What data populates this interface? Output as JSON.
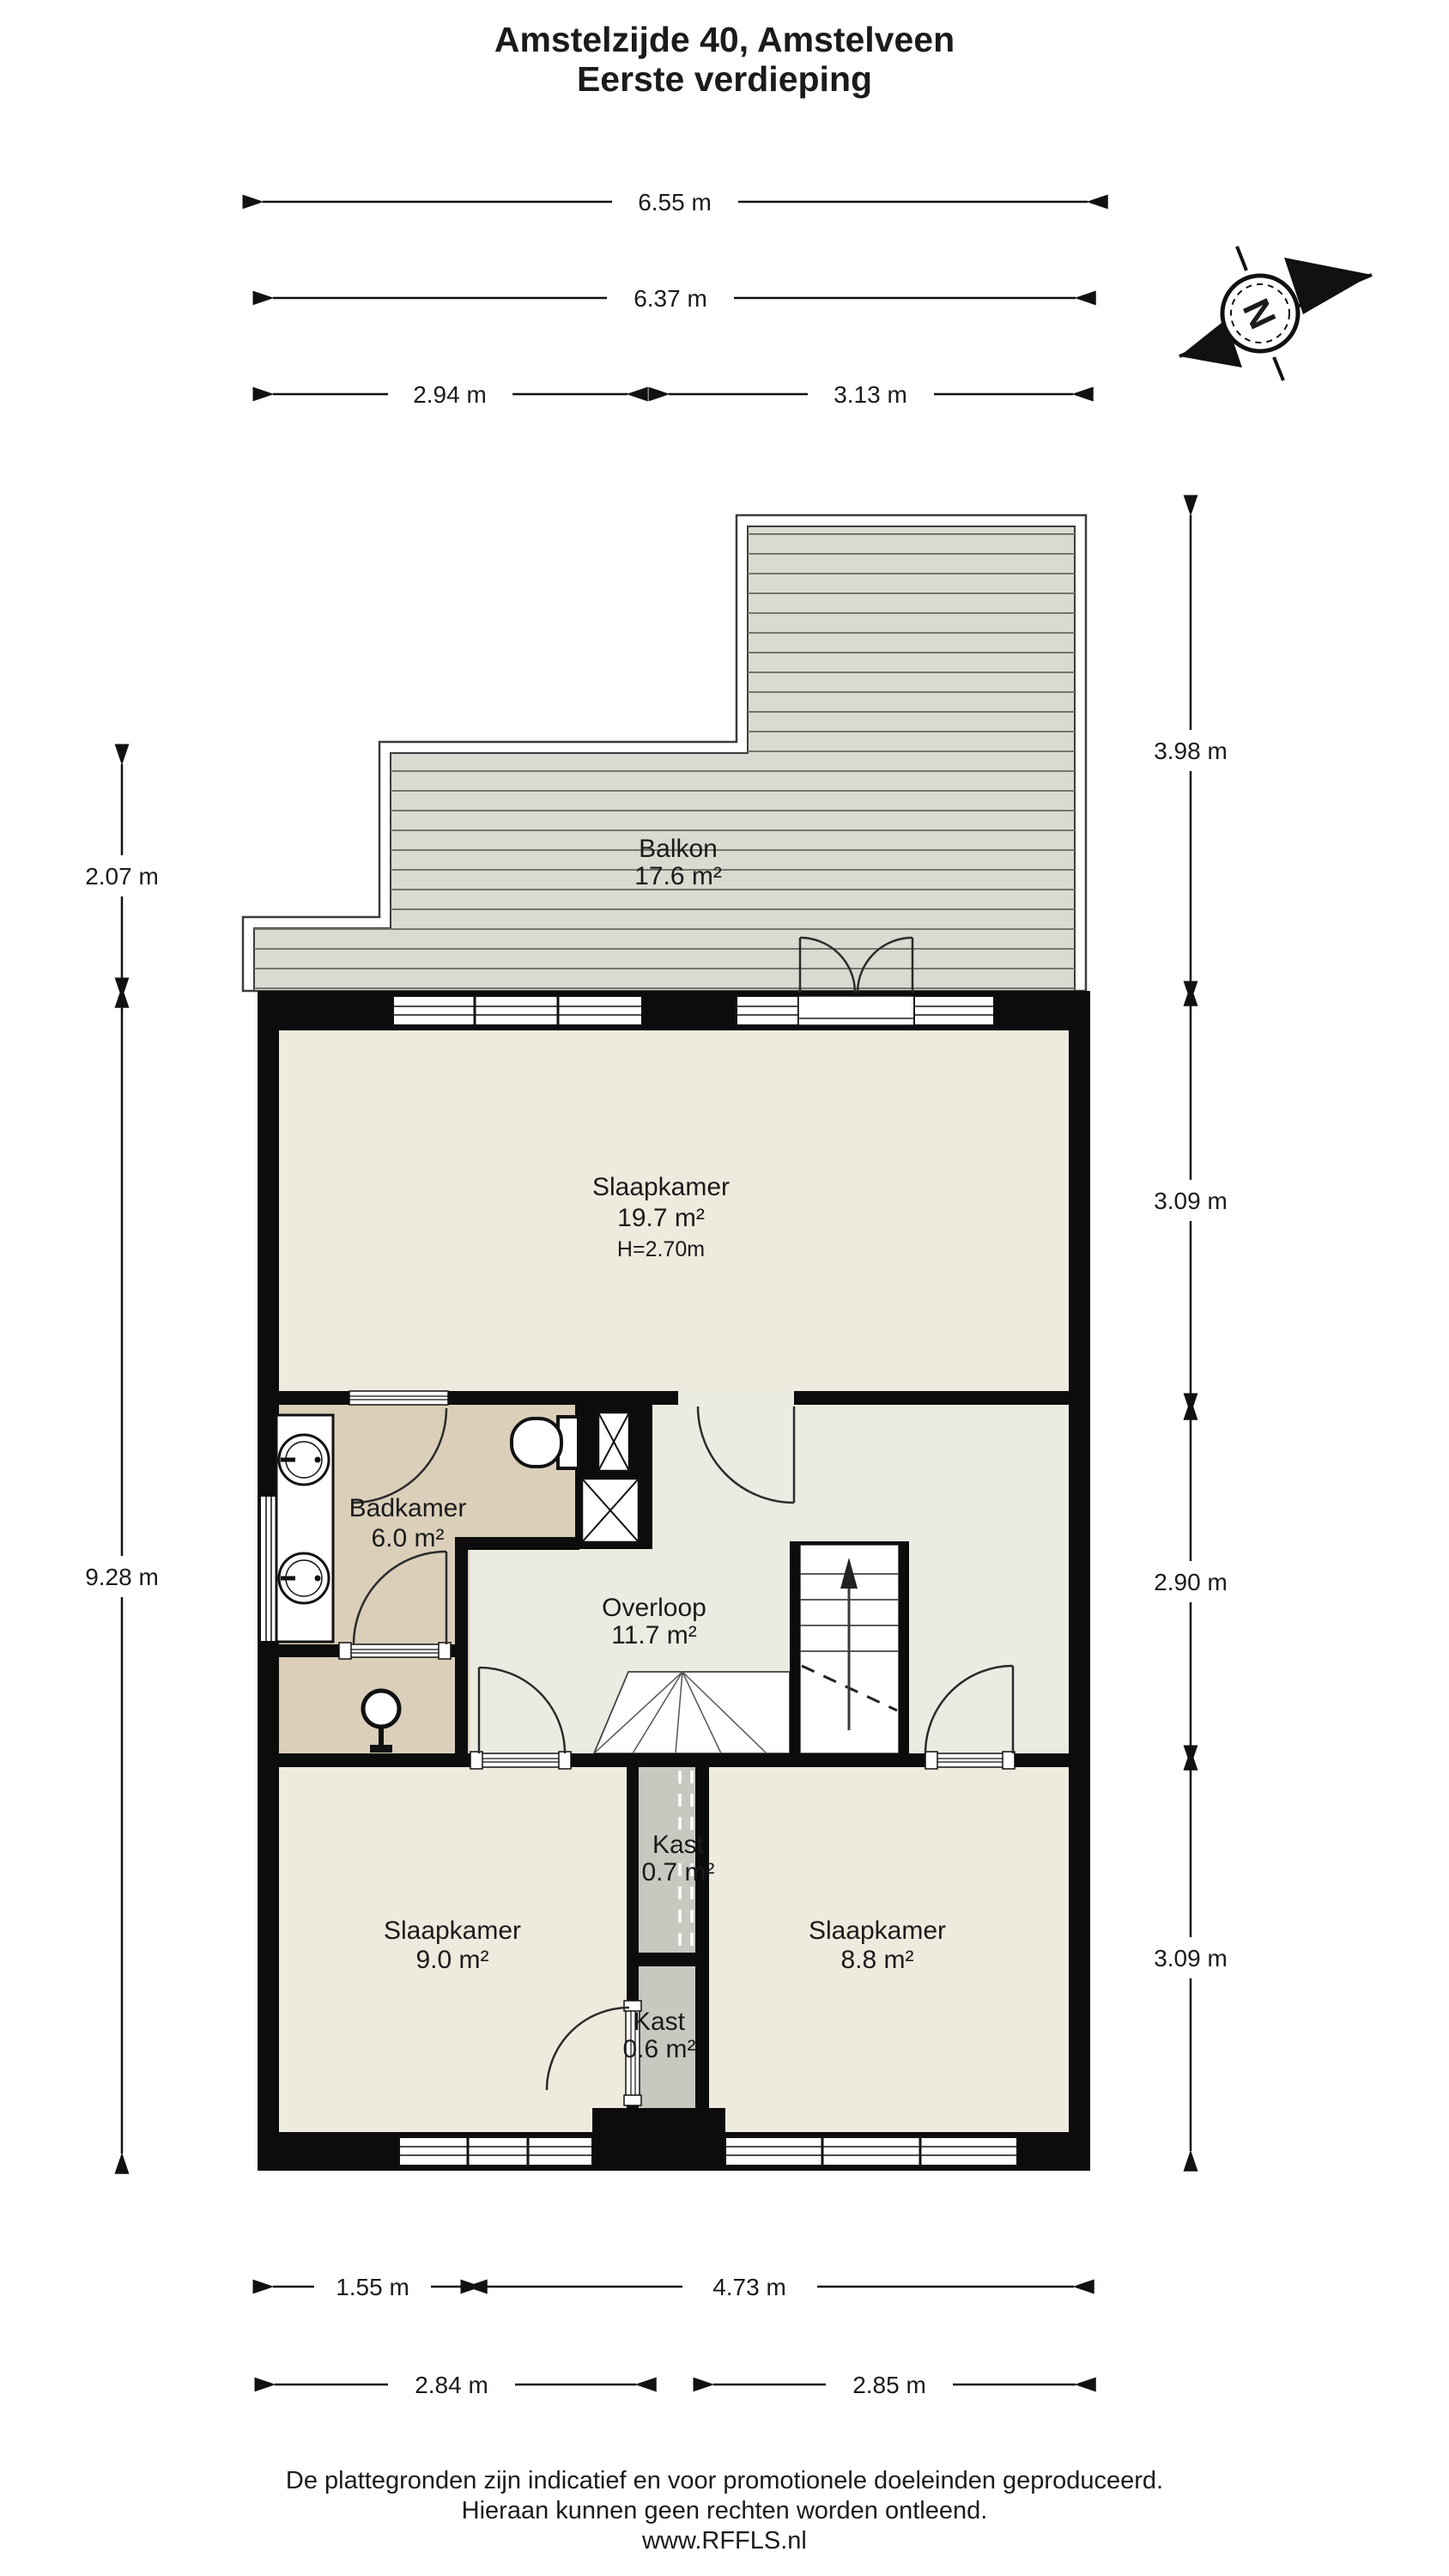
{
  "title": {
    "line1": "Amstelzijde 40, Amstelveen",
    "line2": "Eerste verdieping"
  },
  "compass": {
    "north_label": "N"
  },
  "rooms": {
    "balkon": {
      "name": "Balkon",
      "area": "17.6 m²"
    },
    "slaapkamer1": {
      "name": "Slaapkamer",
      "area": "19.7 m²",
      "ceiling": "H=2.70m"
    },
    "badkamer": {
      "name": "Badkamer",
      "area": "6.0 m²"
    },
    "overloop": {
      "name": "Overloop",
      "area": "11.7 m²"
    },
    "kast1": {
      "name": "Kast",
      "area": "0.7 m²"
    },
    "slaapkamer2": {
      "name": "Slaapkamer",
      "area": "9.0 m²"
    },
    "slaapkamer3": {
      "name": "Slaapkamer",
      "area": "8.8 m²"
    },
    "kast2": {
      "name": "Kast",
      "area": "0.6 m²"
    }
  },
  "dimensions": {
    "top": [
      "6.55 m",
      "6.37 m",
      "2.94 m",
      "3.13 m"
    ],
    "right": [
      "3.98 m",
      "3.09 m",
      "2.90 m",
      "3.09 m"
    ],
    "left": [
      "2.07 m",
      "9.28 m"
    ],
    "bottom": [
      "1.55 m",
      "4.73 m",
      "2.84 m",
      "2.85 m"
    ]
  },
  "footer": {
    "line1": "De plattegronden zijn indicatief en voor promotionele doeleinden geproduceerd.",
    "line2": "Hieraan kunnen geen rechten worden ontleend.",
    "line3": "www.RFFLS.nl"
  },
  "colors": {
    "wall": "#0c0c0c",
    "bedroom_floor": "#efeade",
    "bathroom_floor": "#dbcfba",
    "hall_floor": "#ecebe2",
    "closet_floor": "#c9c8c0",
    "deck": "#dadad1",
    "deck_line": "#75756d",
    "ink": "#1b1b1b"
  }
}
